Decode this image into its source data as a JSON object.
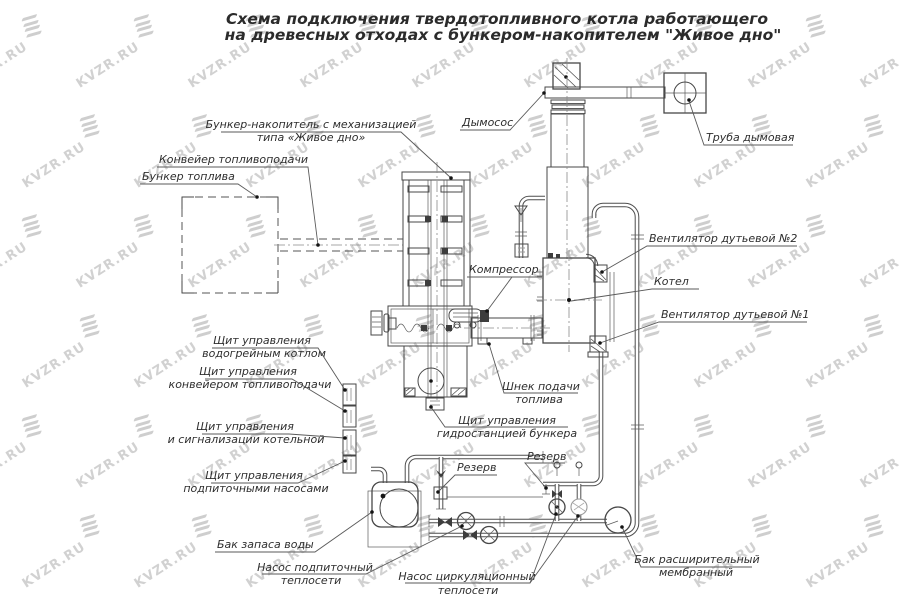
{
  "title": {
    "line1": "Схема подключения твердотопливного котла работающего",
    "line2": "на древесных отходах с бункером-накопителем \"Живое дно\""
  },
  "watermark": {
    "text": "KVZR.RU"
  },
  "colors": {
    "background": "#ffffff",
    "line": "#474747",
    "watermark": "#c6c6c6",
    "text": "#2e2e2e"
  },
  "labels": {
    "storage_bunker": {
      "line1": "Бункер-накопитель с механизацией",
      "line2": "типа «Живое дно»"
    },
    "conveyor": {
      "text": "Конвейер топливоподачи"
    },
    "fuel_bunker": {
      "text": "Бункер топлива"
    },
    "smoke_exhauster": {
      "text": "Дымосос"
    },
    "chimney": {
      "text": "Труба дымовая"
    },
    "compressor": {
      "text": "Компрессор"
    },
    "fan2": {
      "text": "Вентилятор дутьевой №2"
    },
    "boiler": {
      "text": "Котел"
    },
    "fan1": {
      "text": "Вентилятор дутьевой №1"
    },
    "feed_screw": {
      "line1": "Шнек подачи",
      "line2": "топлива"
    },
    "panel_hydro": {
      "line1": "Щит управления",
      "line2": "гидростанцией бункера"
    },
    "panel_boiler": {
      "line1": "Щит управления",
      "line2": "водогрейным котлом"
    },
    "panel_conveyor": {
      "line1": "Щит управления",
      "line2": "конвейером топливоподачи"
    },
    "panel_alarm": {
      "line1": "Щит управления",
      "line2": "и сигнализации котельной"
    },
    "panel_pumps": {
      "line1": "Щит управления",
      "line2": "подпиточными насосами"
    },
    "reserve1": {
      "text": "Резерв"
    },
    "reserve2": {
      "text": "Резерв"
    },
    "water_tank": {
      "text": "Бак запаса воды"
    },
    "makeup_pump": {
      "line1": "Насос подпиточный",
      "line2": "теплосети"
    },
    "circ_pump": {
      "line1": "Насос циркуляционный",
      "line2": "теплосети"
    },
    "exp_tank": {
      "line1": "Бак расширительный",
      "line2": "мембранный"
    }
  }
}
